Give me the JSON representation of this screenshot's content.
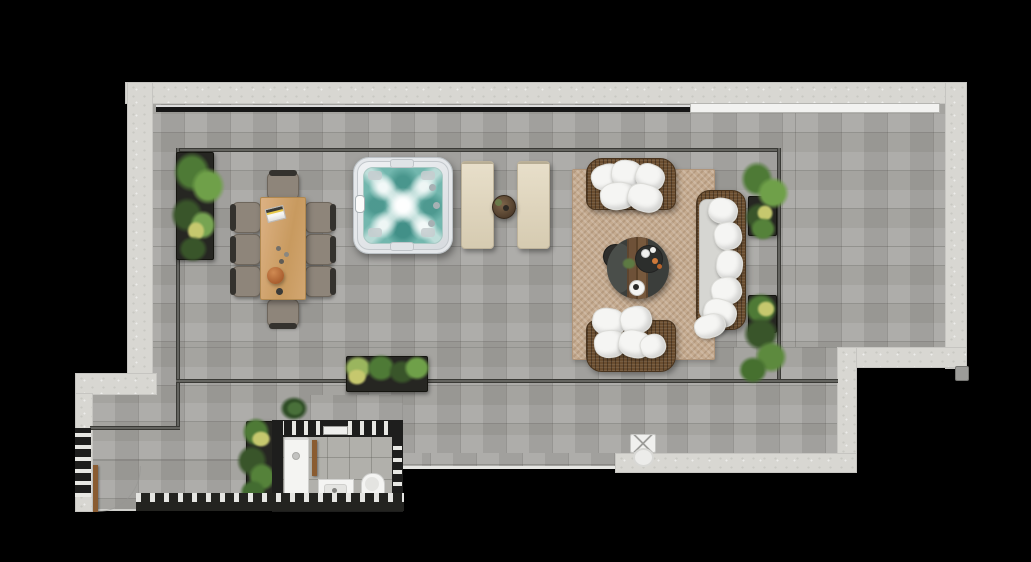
{
  "meta": {
    "title": "Rooftop terrace penthouse floor plan",
    "type": "architectural-floor-plan-top-view",
    "canvas_width": 1031,
    "canvas_height": 562
  },
  "colors": {
    "background": "#000000",
    "wall": "#d8d7d2",
    "floor": "#a7a6a1",
    "interiorTile": "#b1b0ab",
    "railing": "#3c3c38",
    "stripDark": "#161616",
    "stripLight": "#f2f2f0",
    "rug": "#c5ab90",
    "rugEdge": "#b0957a",
    "wicker": "#6b4e30",
    "cushion": "#f5f5f3",
    "sofaSeat": "#d6d6d2",
    "tubShell": "#e9ebed",
    "tubRim": "#bcc2c6",
    "tubWater": "#72b7ae",
    "tubWaterDeep": "#47948b",
    "lounger": "#e0d6bf",
    "loungerEdge": "#bdb29a",
    "tableWood": "#d0a46f",
    "chairSeat": "#8e857a",
    "chairFrame": "#34322e",
    "planter": "#262622",
    "plantDark": "#39552a",
    "plantMid": "#4e7a36",
    "plantLight": "#6fa049",
    "plantAccent": "#c6c86e",
    "bathWall": "#1e1e1d",
    "hatchLight": "#e8e8e4",
    "fixture": "#f4f4f2",
    "fixtureInner": "#e4e4e1",
    "door": "#8a5c31",
    "bowl": "#b06a3a",
    "coffeeDark": "#3b3e3b",
    "coffeeWood": "#6e5138"
  },
  "zones": [
    {
      "id": "upper-terrace",
      "label": "Upper terrace (railed)"
    },
    {
      "id": "lower-walkway",
      "label": "Lower terrace walkway"
    },
    {
      "id": "service-area",
      "label": "Lower-left service area"
    },
    {
      "id": "bathroom",
      "label": "Bathroom enclosure"
    }
  ],
  "items": [
    {
      "id": "hot-tub",
      "label": "Square hot tub / jacuzzi with teal water"
    },
    {
      "id": "sun-loungers",
      "label": "Beige sun loungers",
      "count": 2
    },
    {
      "id": "lounger-side-table",
      "label": "Round wooden side table between loungers"
    },
    {
      "id": "dining-table",
      "label": "Rectangular wooden dining table"
    },
    {
      "id": "dining-chairs",
      "label": "Dining chairs",
      "count": 8
    },
    {
      "id": "area-rug",
      "label": "Jute area rug"
    },
    {
      "id": "loveseat-north",
      "label": "Wicker loveseat with white cushions (north)"
    },
    {
      "id": "loveseat-south",
      "label": "Wicker loveseat with white cushions (south)"
    },
    {
      "id": "sofa-east",
      "label": "Wicker chaise sofa with white cushions (east)"
    },
    {
      "id": "coffee-table",
      "label": "Round coffee table with wood plank stripe"
    },
    {
      "id": "planters",
      "label": "Dark rectangular planters with greenery",
      "count": 6
    },
    {
      "id": "shower",
      "label": "Walk-in shower tray"
    },
    {
      "id": "sink",
      "label": "Washbasin vanity"
    },
    {
      "id": "toilet",
      "label": "Toilet"
    },
    {
      "id": "doors",
      "label": "Wooden door leaves with swing arc",
      "count": 2
    },
    {
      "id": "floor-drain",
      "label": "Floor drain / gully fixture"
    },
    {
      "id": "skylight-strip",
      "label": "Linear skylight / glass balustrade strip along top wall"
    },
    {
      "id": "slat-screen",
      "label": "Slatted privacy screen band (south edge)"
    }
  ]
}
